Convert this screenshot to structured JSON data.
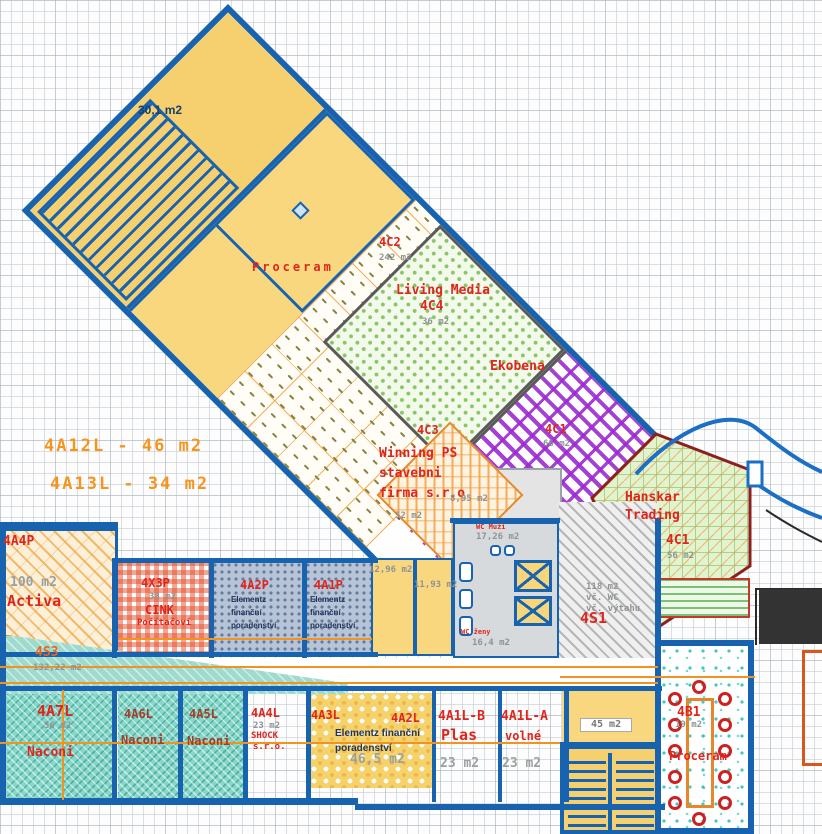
{
  "plan": {
    "colors": {
      "wall_blue": "#1763b0",
      "label_red": "#e0251c",
      "note_orange": "#f7941d",
      "dim_gray": "#8e9494",
      "ekobena_purple": "#9c2ad2",
      "hanskar_green": "#e2f3cf",
      "teal_room": "#86d7c9",
      "room_yellow": "#f9d77e"
    },
    "labels": [
      {
        "n": "note-4a12l",
        "t": "4A12L - 46 m2",
        "x": 44,
        "y": 438,
        "c": "orangeT"
      },
      {
        "n": "note-4a13l",
        "t": "4A13L - 34 m2",
        "x": 50,
        "y": 476,
        "c": "orangeT"
      },
      {
        "n": "room-301-area",
        "t": "30,1 m2",
        "x": 138,
        "y": 104,
        "c": "navy"
      },
      {
        "n": "proceram-wing-label",
        "t": "Proceram",
        "x": 252,
        "y": 261,
        "c": "red sp"
      },
      {
        "n": "unit-4c2-code",
        "t": "4C2",
        "x": 379,
        "y": 236,
        "c": "red"
      },
      {
        "n": "unit-4c2-area",
        "t": "242 m2",
        "x": 379,
        "y": 254,
        "c": "gray"
      },
      {
        "n": "living-media-name",
        "t": "Living Media",
        "x": 396,
        "y": 284,
        "c": "red lg"
      },
      {
        "n": "unit-4c4-code",
        "t": "4C4",
        "x": 420,
        "y": 300,
        "c": "red lg"
      },
      {
        "n": "unit-4c4-area",
        "t": "36 m2",
        "x": 422,
        "y": 318,
        "c": "gray"
      },
      {
        "n": "ekobena-name",
        "t": "Ekobena",
        "x": 490,
        "y": 360,
        "c": "red lg"
      },
      {
        "n": "unit-4c1-purple-code",
        "t": "4C1",
        "x": 545,
        "y": 423,
        "c": "red"
      },
      {
        "n": "unit-4c1-purple-area",
        "t": "66 m2",
        "x": 543,
        "y": 440,
        "c": "gray"
      },
      {
        "n": "unit-4c3-code",
        "t": "4C3",
        "x": 417,
        "y": 424,
        "c": "red"
      },
      {
        "n": "winning-ps-line1",
        "t": "Winning PS",
        "x": 379,
        "y": 447,
        "c": "red lg"
      },
      {
        "n": "winning-ps-line2",
        "t": "stavebni",
        "x": 379,
        "y": 467,
        "c": "red lg"
      },
      {
        "n": "winning-ps-line3",
        "t": "firma s.r.o",
        "x": 379,
        "y": 487,
        "c": "red lg"
      },
      {
        "n": "unit-4c3-area",
        "t": "52 m2",
        "x": 395,
        "y": 512,
        "c": "gray"
      },
      {
        "n": "wc-small-area",
        "t": "8,95 m2",
        "x": 450,
        "y": 495,
        "c": "gray"
      },
      {
        "n": "wc-muzi-name",
        "t": "WC Muži",
        "x": 476,
        "y": 524,
        "c": "red tiny"
      },
      {
        "n": "wc-muzi-area",
        "t": "17,26 m2",
        "x": 476,
        "y": 533,
        "c": "gray"
      },
      {
        "n": "wc-zeny-name",
        "t": "WC ženy",
        "x": 461,
        "y": 629,
        "c": "red tiny"
      },
      {
        "n": "wc-zeny-area",
        "t": "16,4 m2",
        "x": 472,
        "y": 639,
        "c": "gray"
      },
      {
        "n": "hanskar-name-line1",
        "t": "Hanskar",
        "x": 625,
        "y": 491,
        "c": "red lg"
      },
      {
        "n": "hanskar-name-line2",
        "t": "Trading",
        "x": 625,
        "y": 509,
        "c": "red lg"
      },
      {
        "n": "unit-4c1-green-code",
        "t": "4C1",
        "x": 666,
        "y": 534,
        "c": "red lg"
      },
      {
        "n": "unit-4c1-green-area",
        "t": "56 m2",
        "x": 667,
        "y": 552,
        "c": "gray"
      },
      {
        "n": "unit-4s1-line1",
        "t": "118 m2",
        "x": 586,
        "y": 583,
        "c": "gray"
      },
      {
        "n": "unit-4s1-line2",
        "t": "vč. WC",
        "x": 586,
        "y": 594,
        "c": "gray"
      },
      {
        "n": "unit-4s1-line3",
        "t": "vč. výtahu",
        "x": 586,
        "y": 605,
        "c": "gray"
      },
      {
        "n": "unit-4s1-code",
        "t": "4S1",
        "x": 580,
        "y": 611,
        "c": "red xl"
      },
      {
        "n": "room-1296-area",
        "t": "12,96 m2",
        "x": 369,
        "y": 566,
        "c": "gray"
      },
      {
        "n": "room-1193-area",
        "t": "11,93 m2",
        "x": 414,
        "y": 581,
        "c": "gray"
      },
      {
        "n": "unit-4a4p-code",
        "t": "4A4P",
        "x": 3,
        "y": 535,
        "c": "red lg"
      },
      {
        "n": "unit-4a4p-area",
        "t": "100 m2",
        "x": 10,
        "y": 576,
        "c": "graylg"
      },
      {
        "n": "activa-name",
        "t": "Activa",
        "x": 7,
        "y": 594,
        "c": "red xl"
      },
      {
        "n": "unit-4s3-code",
        "t": "4S3",
        "x": 35,
        "y": 646,
        "c": "rust"
      },
      {
        "n": "unit-4s3-area",
        "t": "132,22 m2",
        "x": 33,
        "y": 664,
        "c": "gray"
      },
      {
        "n": "unit-4x3p-code",
        "t": "4X3P",
        "x": 141,
        "y": 577,
        "c": "red"
      },
      {
        "n": "unit-4x3p-area",
        "t": "38 m2",
        "x": 149,
        "y": 593,
        "c": "gray"
      },
      {
        "n": "cink-name",
        "t": "CINK",
        "x": 145,
        "y": 604,
        "c": "red"
      },
      {
        "n": "cink-name-line2",
        "t": "Počítačoví",
        "x": 137,
        "y": 619,
        "c": "red sm"
      },
      {
        "n": "unit-4a2p-code",
        "t": "4A2P",
        "x": 240,
        "y": 579,
        "c": "red"
      },
      {
        "n": "a2p-tenant-line1",
        "t": "Elementz",
        "x": 231,
        "y": 596,
        "c": "dark"
      },
      {
        "n": "a2p-tenant-line2",
        "t": "finanční",
        "x": 231,
        "y": 609,
        "c": "dark"
      },
      {
        "n": "a2p-tenant-line3",
        "t": "poradenství",
        "x": 231,
        "y": 622,
        "c": "dark"
      },
      {
        "n": "unit-4a1p-code",
        "t": "4A1P",
        "x": 314,
        "y": 579,
        "c": "red"
      },
      {
        "n": "a1p-tenant-line1",
        "t": "Elementz",
        "x": 310,
        "y": 596,
        "c": "dark"
      },
      {
        "n": "a1p-tenant-line2",
        "t": "finanční",
        "x": 310,
        "y": 609,
        "c": "dark"
      },
      {
        "n": "a1p-tenant-line3",
        "t": "poradenství",
        "x": 310,
        "y": 622,
        "c": "dark"
      },
      {
        "n": "unit-4a7l-code",
        "t": "4A7L",
        "x": 37,
        "y": 704,
        "c": "red xl"
      },
      {
        "n": "unit-4a7l-area",
        "t": "56 m2",
        "x": 44,
        "y": 722,
        "c": "gray"
      },
      {
        "n": "naconi-4a7l",
        "t": "Naconi",
        "x": 27,
        "y": 746,
        "c": "red lg"
      },
      {
        "n": "unit-4a6l-code",
        "t": "4A6L",
        "x": 124,
        "y": 708,
        "c": "rust2"
      },
      {
        "n": "naconi-4a6l",
        "t": "Naconi",
        "x": 121,
        "y": 734,
        "c": "rust2 sm2"
      },
      {
        "n": "unit-4a5l-code",
        "t": "4A5L",
        "x": 189,
        "y": 708,
        "c": "rust2"
      },
      {
        "n": "naconi-4a5l",
        "t": "Naconi",
        "x": 187,
        "y": 735,
        "c": "rust2 sm2"
      },
      {
        "n": "unit-4a4l-code",
        "t": "4A4L",
        "x": 251,
        "y": 707,
        "c": "red"
      },
      {
        "n": "unit-4a4l-area",
        "t": "23 m2",
        "x": 253,
        "y": 722,
        "c": "gray"
      },
      {
        "n": "shock-name",
        "t": "SHOCK",
        "x": 251,
        "y": 732,
        "c": "red sm"
      },
      {
        "n": "shock-sro",
        "t": "s.r.o.",
        "x": 253,
        "y": 743,
        "c": "red sm"
      },
      {
        "n": "unit-4a3l-code",
        "t": "4A3L",
        "x": 311,
        "y": 709,
        "c": "red"
      },
      {
        "n": "unit-4a2l-code",
        "t": "4A2L",
        "x": 391,
        "y": 712,
        "c": "red"
      },
      {
        "n": "a2l-tenant-line1",
        "t": "Elementz finanční",
        "x": 335,
        "y": 729,
        "c": "dark mdD"
      },
      {
        "n": "a2l-tenant-line2",
        "t": "poradenství",
        "x": 335,
        "y": 744,
        "c": "dark mdD"
      },
      {
        "n": "unit-4a2l-area",
        "t": "46,5 m2",
        "x": 350,
        "y": 753,
        "c": "graylg"
      },
      {
        "n": "unit-4a1lb-code",
        "t": "4A1L-B",
        "x": 438,
        "y": 710,
        "c": "red lg"
      },
      {
        "n": "plas-name",
        "t": "Plas",
        "x": 441,
        "y": 728,
        "c": "red xl"
      },
      {
        "n": "unit-4a1lb-area",
        "t": "23 m2",
        "x": 440,
        "y": 757,
        "c": "graylg"
      },
      {
        "n": "unit-4a1la-code",
        "t": "4A1L-A",
        "x": 501,
        "y": 710,
        "c": "red lg"
      },
      {
        "n": "volne-label",
        "t": "volné",
        "x": 505,
        "y": 730,
        "c": "red"
      },
      {
        "n": "unit-4a1la-area",
        "t": "23 m2",
        "x": 502,
        "y": 757,
        "c": "graylg"
      },
      {
        "n": "corridor-area",
        "t": "45 m2",
        "x": 580,
        "y": 718,
        "c": "tag"
      },
      {
        "n": "unit-4b1-code",
        "t": "4B1",
        "x": 677,
        "y": 706,
        "c": "red lg"
      },
      {
        "n": "unit-4b1-area",
        "t": "19 m2",
        "x": 675,
        "y": 721,
        "c": "gray"
      },
      {
        "n": "proceram-4b1",
        "t": "Proceram",
        "x": 669,
        "y": 750,
        "c": "red"
      }
    ]
  }
}
